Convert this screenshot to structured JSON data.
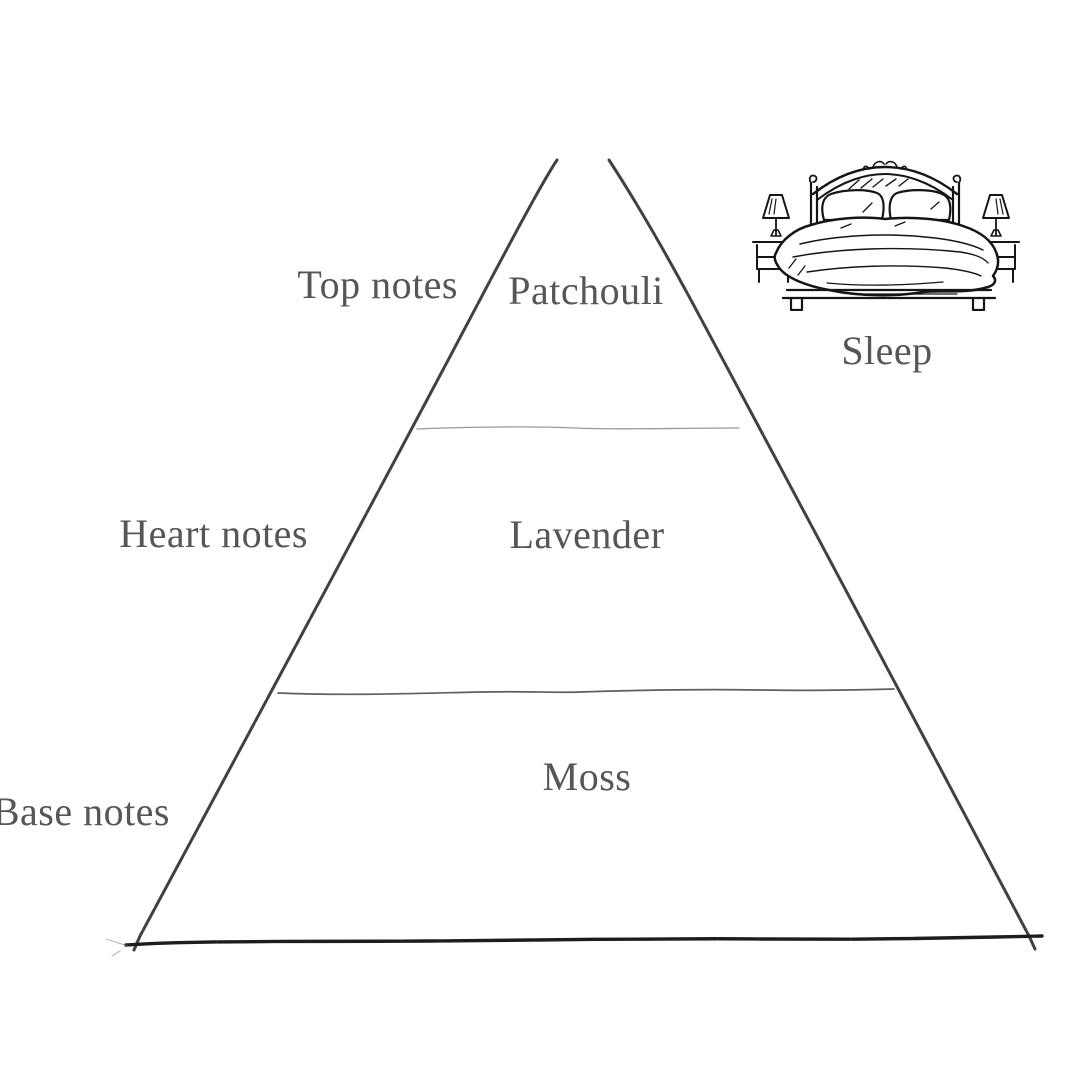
{
  "diagram": {
    "title": "fragrance-note-pyramid",
    "pyramid": {
      "levels": [
        {
          "tier_label": "Top notes",
          "note": "Patchouli"
        },
        {
          "tier_label": "Heart notes",
          "note": "Lavender"
        },
        {
          "tier_label": "Base notes",
          "note": "Moss"
        }
      ]
    },
    "mood": {
      "label": "Sleep",
      "icon": "bed-icon"
    },
    "colors": {
      "background": "#ffffff",
      "label_text": "#56565a",
      "pyramid_side": "#414144",
      "pyramid_base": "#1d1d1f",
      "divider_light": "#9a9a9a",
      "divider_dark": "#5f5f5f",
      "illustration_ink": "#151515"
    }
  }
}
